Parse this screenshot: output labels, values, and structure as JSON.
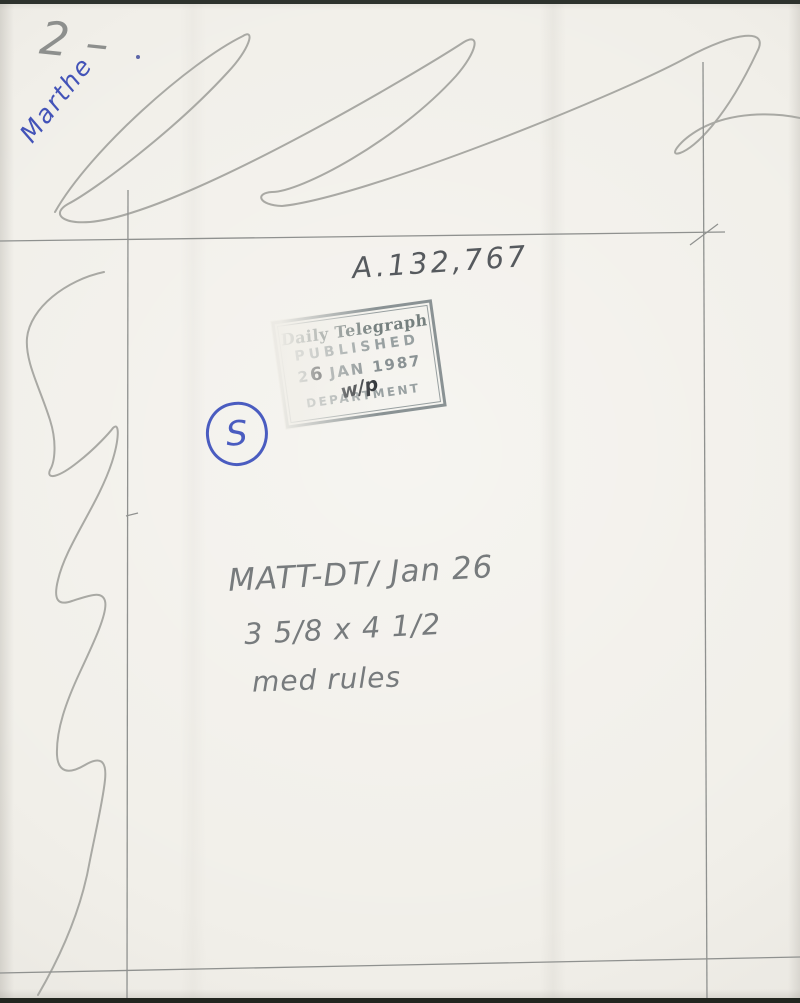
{
  "annotations": {
    "page_number": "2 –",
    "name": "Marthe",
    "reference_number": "A.132,767",
    "grade_mark": "S",
    "notes": [
      "MATT-DT/ Jan 26",
      "3 5/8 x 4 1/2",
      "med rules"
    ]
  },
  "stamp": {
    "newspaper": "Daily Telegraph",
    "status": "PUBLISHED",
    "date_prefix": "2",
    "date_overwritten": "6",
    "date_suffix": "JAN 1987",
    "process_mark": "w/p",
    "department": "DEPARTMENT"
  },
  "colors": {
    "paper": "#f1efe9",
    "pencil_light": "#a9a9a4",
    "pencil_dark": "#6e7276",
    "blue_ink": "#4353b8",
    "stamp_ink": "#8a9294",
    "stamp_overwrite_ink": "#2b2f33"
  }
}
